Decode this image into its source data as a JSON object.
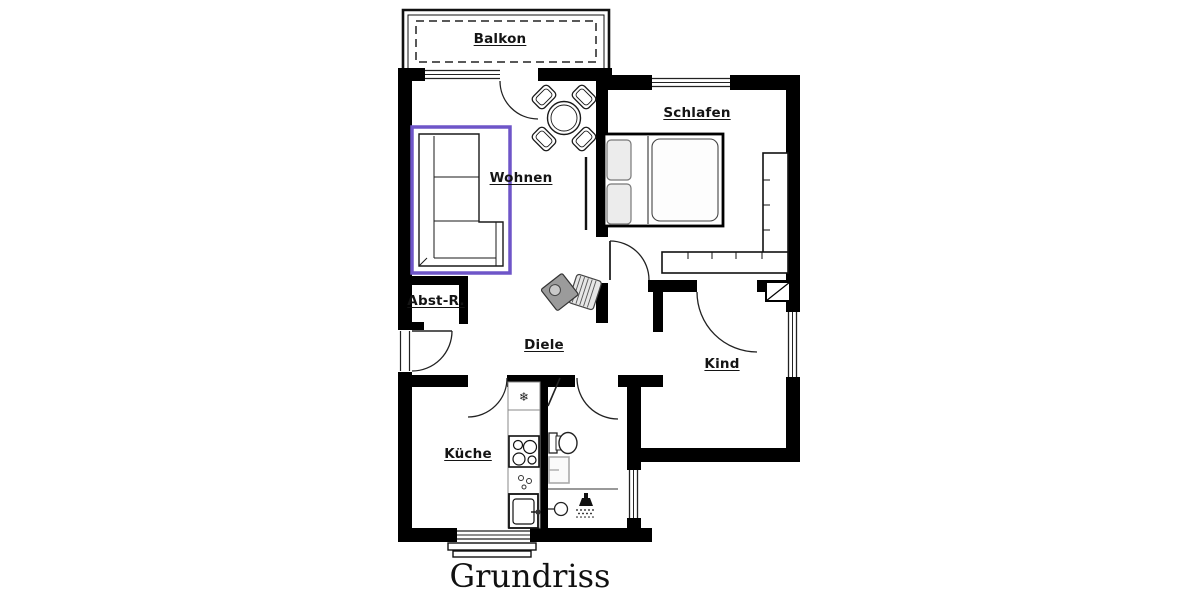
{
  "title": "Grundriss",
  "rooms": {
    "balkon": {
      "label": "Balkon"
    },
    "wohnen": {
      "label": "Wohnen"
    },
    "schlafen": {
      "label": "Schlafen"
    },
    "abstellraum": {
      "label": "Abst-R."
    },
    "diele": {
      "label": "Diele"
    },
    "kind": {
      "label": "Kind"
    },
    "kueche": {
      "label": "Küche"
    }
  },
  "colors": {
    "walls": "#000000",
    "highlight": "#6e55c8",
    "background": "#ffffff",
    "fixture_gray": "#999999"
  },
  "icons": {
    "fridge_glyph": "❄",
    "furniture": [
      "sofa",
      "dining-table-with-chairs",
      "double-bed",
      "wardrobe",
      "stove",
      "sink",
      "fridge",
      "toilet",
      "washbasin",
      "shower",
      "chair",
      "radiator"
    ]
  }
}
